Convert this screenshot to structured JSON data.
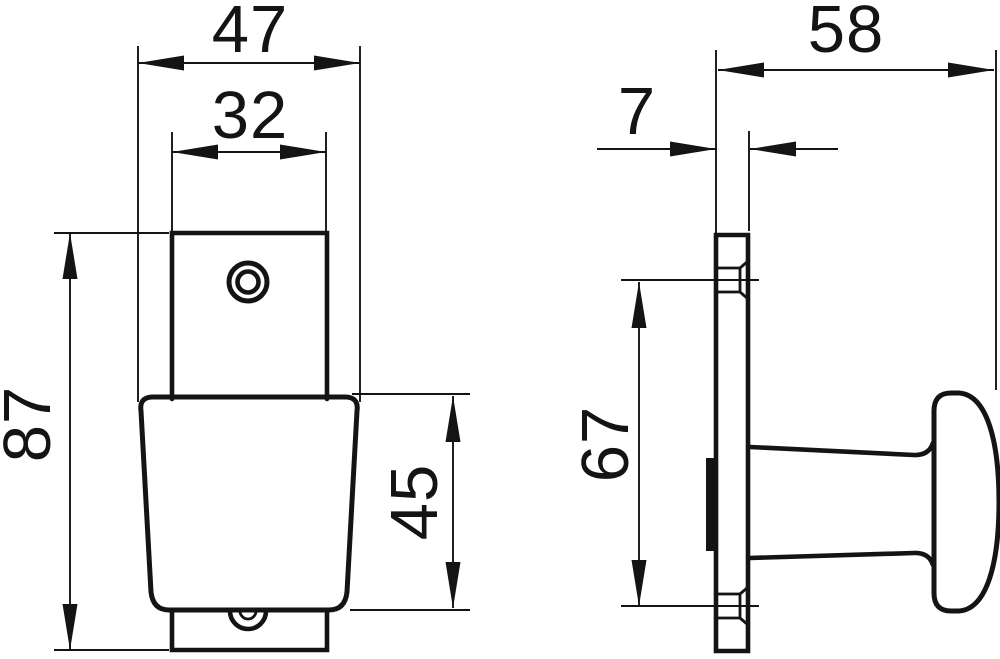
{
  "drawing": {
    "background": "#ffffff",
    "line_color": "#141414",
    "front_view": {
      "dim_overall_width": "47",
      "dim_plate_width": "32",
      "dim_overall_height": "87",
      "dim_knob_height": "45"
    },
    "side_view": {
      "dim_depth": "58",
      "dim_plate_thickness": "7",
      "dim_hole_spacing": "67"
    }
  }
}
